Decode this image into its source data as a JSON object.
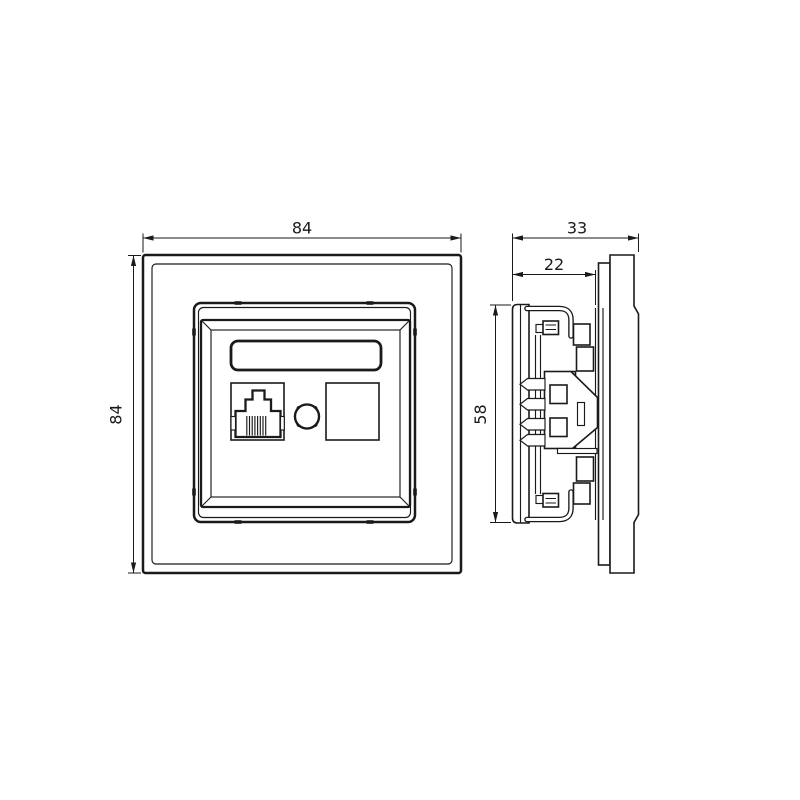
{
  "colors": {
    "line": "#1a1a1a",
    "background": "#ffffff"
  },
  "views": {
    "front": {
      "dimensions": {
        "width": "84",
        "height": "84"
      }
    },
    "side": {
      "dimensions": {
        "total_depth": "33",
        "insert_depth": "22",
        "mount_height": "58"
      }
    }
  }
}
